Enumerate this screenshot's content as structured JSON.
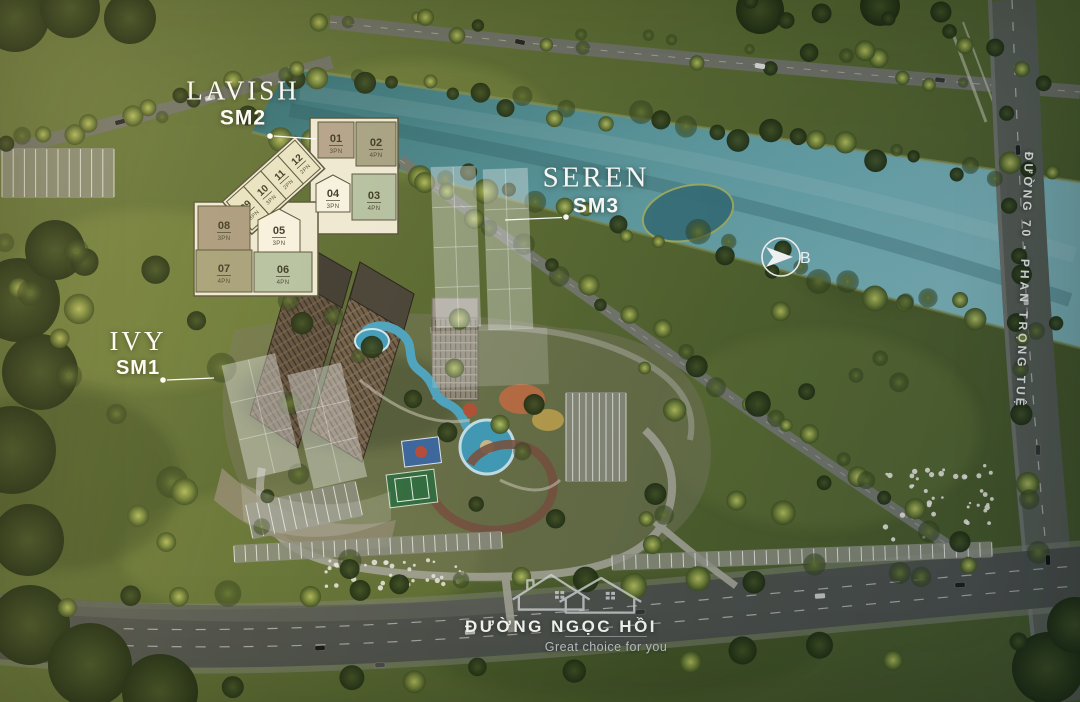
{
  "masterplan": {
    "towers": [
      {
        "id": "lavish",
        "name": "LAVISH",
        "code": "SM2"
      },
      {
        "id": "seren",
        "name": "SEREN",
        "code": "SM3"
      },
      {
        "id": "ivy",
        "name": "IVY",
        "code": "SM1"
      }
    ],
    "floorplan_units": [
      {
        "no": "01",
        "type": "3PN"
      },
      {
        "no": "02",
        "type": "4PN"
      },
      {
        "no": "03",
        "type": "4PN"
      },
      {
        "no": "04",
        "type": "3PN"
      },
      {
        "no": "05",
        "type": "3PN"
      },
      {
        "no": "06",
        "type": "4PN"
      },
      {
        "no": "07",
        "type": "4PN"
      },
      {
        "no": "08",
        "type": "3PN"
      },
      {
        "no": "09",
        "type": "3PN"
      },
      {
        "no": "10",
        "type": "3PN"
      },
      {
        "no": "11",
        "type": "2PN"
      },
      {
        "no": "12",
        "type": "2PN"
      }
    ],
    "compass_label": "B",
    "roads": {
      "east": "ĐƯỜNG 70 - PHAN TRỌNG TUỆ",
      "south": "ĐƯỜNG NGỌC HỒI"
    },
    "watermark_tagline": "Great choice for you",
    "colors": {
      "unit_2pn": "#e9e5c6",
      "unit_3pn_tan": "#b2a38c",
      "unit_3pn_white": "#f7f3e3",
      "unit_4pn_olive": "#a6a285",
      "unit_4pn_sage": "#b5c2a4",
      "river": "#4f8f96",
      "grass": "#5d6c35",
      "label_text": "#ffffff"
    }
  }
}
